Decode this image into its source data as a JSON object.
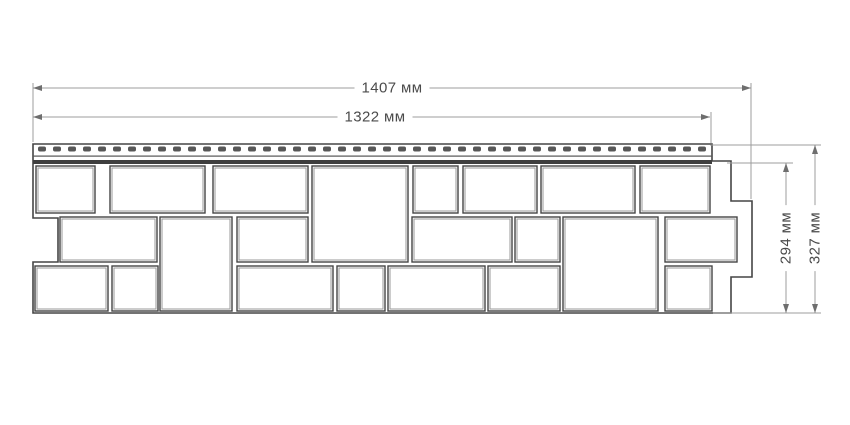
{
  "drawing_title": "siding-panel-dimension-drawing",
  "labels": {
    "width_total": "1407 мм",
    "width_visible": "1322 мм",
    "height_visible": "294 мм",
    "height_total": "327 мм"
  },
  "colors": {
    "background": "#ffffff",
    "outline": "#454545",
    "block_fill": "#ffffff",
    "block_inner_line": "#9a9a9a",
    "nail_slot": "#575757",
    "strip_line": "#565656",
    "strip_band": "#3e3e3e",
    "dim_line": "#9c9c9c",
    "arrow": "#6e6e6e",
    "text": "#4b4b4b"
  },
  "panel": {
    "outline_points": "33,144 712,144 712,161 731,161 731,201 752,201 752,277 731,277 731,313 33,313 33,262 58,262 58,218 33,218",
    "strip": {
      "x": 33,
      "y": 144,
      "width": 679,
      "dash_start": 38,
      "dash_y": 146.5,
      "dash_w": 8,
      "dash_h": 5,
      "dash_pitch": 15,
      "dash_end": 706,
      "line_y": 155.5,
      "line_h": 1.2,
      "band_y": 160,
      "band_h": 4
    },
    "blocks": [
      {
        "x": 36,
        "y": 166,
        "w": 59,
        "h": 47
      },
      {
        "x": 110,
        "y": 166,
        "w": 95,
        "h": 47
      },
      {
        "x": 213,
        "y": 166,
        "w": 95,
        "h": 47
      },
      {
        "x": 312,
        "y": 166,
        "w": 96,
        "h": 96
      },
      {
        "x": 413,
        "y": 166,
        "w": 45,
        "h": 47
      },
      {
        "x": 463,
        "y": 166,
        "w": 74,
        "h": 47
      },
      {
        "x": 541,
        "y": 166,
        "w": 94,
        "h": 47
      },
      {
        "x": 640,
        "y": 166,
        "w": 70,
        "h": 47
      },
      {
        "x": 60,
        "y": 217,
        "w": 97,
        "h": 45
      },
      {
        "x": 160,
        "y": 217,
        "w": 72,
        "h": 94
      },
      {
        "x": 237,
        "y": 217,
        "w": 71,
        "h": 45
      },
      {
        "x": 412,
        "y": 217,
        "w": 100,
        "h": 45
      },
      {
        "x": 515,
        "y": 217,
        "w": 45,
        "h": 45
      },
      {
        "x": 563,
        "y": 217,
        "w": 95,
        "h": 94
      },
      {
        "x": 665,
        "y": 217,
        "w": 72,
        "h": 45
      },
      {
        "x": 35,
        "y": 266,
        "w": 73,
        "h": 45
      },
      {
        "x": 112,
        "y": 266,
        "w": 46,
        "h": 45
      },
      {
        "x": 237,
        "y": 266,
        "w": 96,
        "h": 45
      },
      {
        "x": 337,
        "y": 266,
        "w": 48,
        "h": 45
      },
      {
        "x": 388,
        "y": 266,
        "w": 97,
        "h": 45
      },
      {
        "x": 488,
        "y": 266,
        "w": 72,
        "h": 45
      },
      {
        "x": 665,
        "y": 266,
        "w": 47,
        "h": 45
      }
    ]
  },
  "dimensions": {
    "horizontal": [
      {
        "name": "width-total",
        "y": 88,
        "x1": 33,
        "x2": 751,
        "ext": [
          {
            "x": 33,
            "y1": 83,
            "y2": 142
          },
          {
            "x": 751,
            "y1": 83,
            "y2": 199
          }
        ]
      },
      {
        "name": "width-visible",
        "y": 117,
        "x1": 33,
        "x2": 710,
        "ext": [
          {
            "x": 711,
            "y1": 112,
            "y2": 143
          }
        ]
      }
    ],
    "vertical": [
      {
        "name": "height-visible",
        "x": 786,
        "y1": 163,
        "y2": 313,
        "ext": [
          {
            "y": 163,
            "x1": 727,
            "x2": 793
          }
        ]
      },
      {
        "name": "height-total",
        "x": 815,
        "y1": 145,
        "y2": 313,
        "ext": [
          {
            "y": 145,
            "x1": 710,
            "x2": 821
          },
          {
            "y": 313,
            "x1": 713,
            "x2": 821
          }
        ]
      }
    ]
  }
}
